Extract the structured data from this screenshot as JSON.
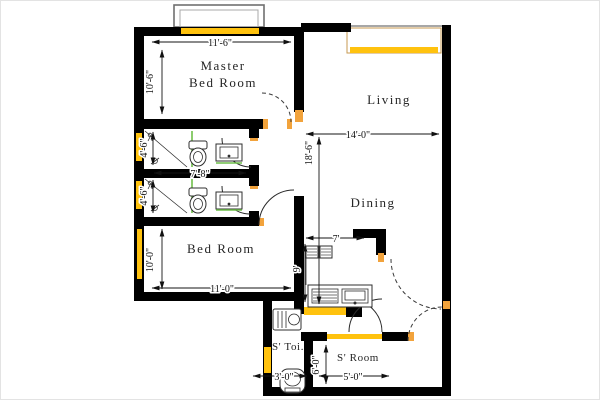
{
  "drawing": {
    "type": "apartment-floor-plan",
    "labels": {
      "master_bedroom_line1": "Master",
      "master_bedroom_line2": "Bed Room",
      "living": "Living",
      "dining": "Dining",
      "bedroom": "Bed Room",
      "servant_toilet": "S' Toi.",
      "servant_room": "S' Room"
    },
    "dimensions": {
      "master_width": "11'-6\"",
      "master_depth": "10'-6\"",
      "living_dining_width": "14'-0\"",
      "living_dining_depth": "18'-6\"",
      "toilet_top_depth": "4'-6\"",
      "toilet_bottom_width": "7'-8\"",
      "toilet_bottom_depth": "4'-6\"",
      "bedroom_width": "11'-0\"",
      "bedroom_depth": "10'-0\"",
      "kitchen_width": "7'",
      "kitchen_depth": "9'",
      "servant_room_depth": "6'-0\"",
      "servant_toilet_width": "3'-0\"",
      "servant_room_width": "5'-0\""
    },
    "colors": {
      "wall": "#000000",
      "window": "#FFC20E",
      "door_jamb": "#F2A33C",
      "fixture_accent_green": "#6FBF4A",
      "dimension_text": "#111111"
    }
  }
}
